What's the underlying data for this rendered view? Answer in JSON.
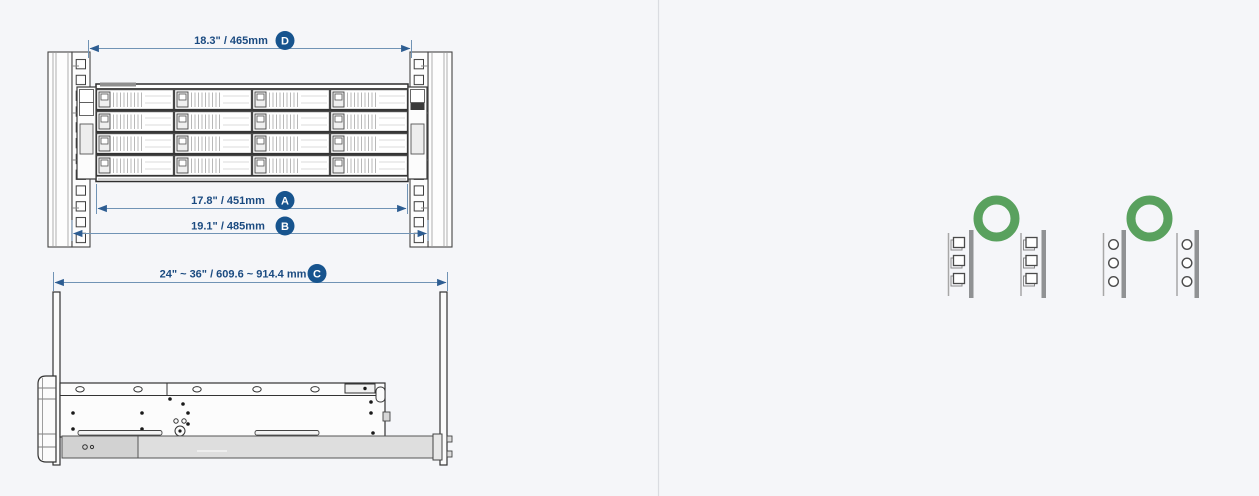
{
  "front_view": {
    "description": "rack front view with 16-bay enclosure mounted between square-hole posts",
    "dimensions": [
      {
        "id": "D",
        "label": "18.3\" / 465mm"
      },
      {
        "id": "A",
        "label": "17.8\" / 451mm"
      },
      {
        "id": "B",
        "label": "19.1\" / 485mm"
      }
    ]
  },
  "side_view": {
    "description": "slide rail kit side view between front and rear rack posts",
    "dimensions": [
      {
        "id": "C",
        "label": "24\" ~ 36\" / 609.6 ~ 914.4 mm"
      }
    ]
  },
  "compatibility": {
    "items": [
      {
        "rack_type": "square-hole-posts",
        "status": "compatible"
      },
      {
        "rack_type": "round-hole-posts",
        "status": "compatible"
      }
    ]
  },
  "colors": {
    "background": "#f5f6f9",
    "divider": "#dadce1",
    "dimension_line": "#7093b5",
    "dimension_arrow": "#2d5d92",
    "dimension_text": "#1a4a80",
    "badge": "#17548e",
    "compatible_green": "#59a15e",
    "line_art": "#333333",
    "rail_gray": "#dedede"
  }
}
